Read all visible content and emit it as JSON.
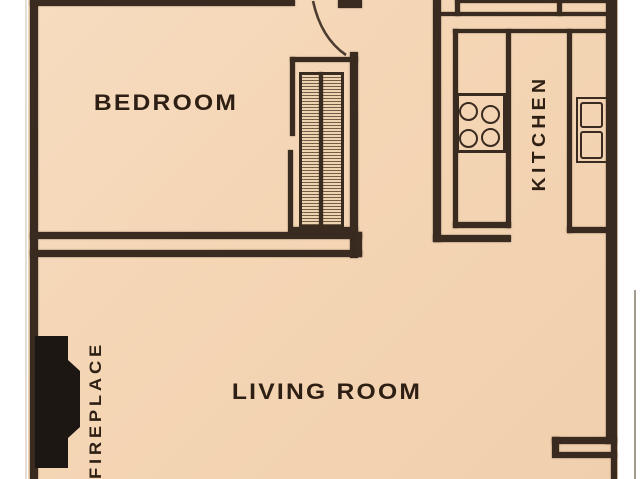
{
  "floor_plan": {
    "labels": {
      "bedroom": "BEDROOM",
      "kitchen": "KITCHEN",
      "living_room": "LIVING ROOM",
      "fireplace": "FIREPLACE"
    },
    "colors": {
      "floor": "#f4d5b4",
      "wall": "#3a2b21",
      "text": "#2e1f14",
      "fireplace": "#1c1712",
      "background": "#ffffff",
      "photo_edge": "#a39a90"
    },
    "fixtures": [
      "entry-door-arc",
      "bedroom-closet",
      "upper-cabinets",
      "stove",
      "sink",
      "fireplace",
      "entry-alcove"
    ]
  }
}
